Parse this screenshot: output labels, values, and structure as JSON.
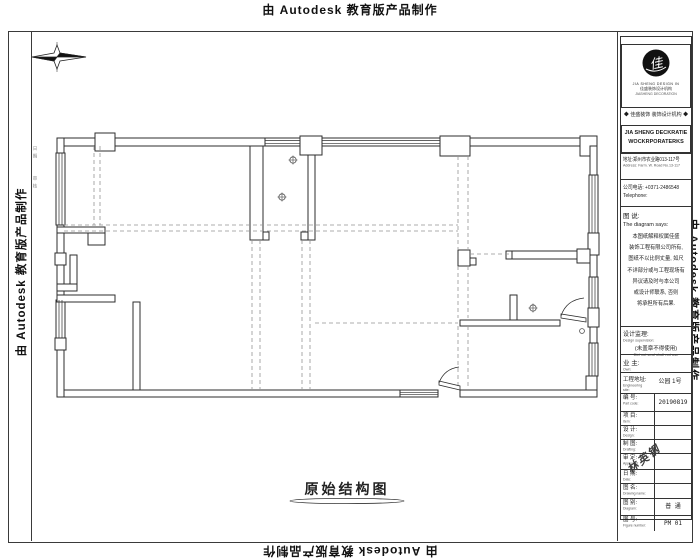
{
  "watermark": {
    "text": "由 Autodesk 教育版产品制作"
  },
  "margin_notes": {
    "note1": "日 期",
    "note2": "审 核"
  },
  "plan": {
    "title": "原始结构图",
    "icons": {
      "compass": "north-arrow-compass",
      "column_marker": "circled-cross-marker"
    }
  },
  "title_block": {
    "logo": {
      "mark_text": "佳盛",
      "caption_en": "JIA SHENG DESIGN IN",
      "caption_zh": "佳盛装饰设计机构",
      "caption_sub": "JIASHENG DECORATION"
    },
    "tagline": "◆ 佳盛装饰 装饰设计机构 ◆",
    "company_en_line1": "JIA SHENG DECKRATIE",
    "company_en_line2": "WOCKRPORATERKS",
    "address_zh": "地址:郑州市农业路013-117号",
    "address_en": "Address: Farm. W. Road No.13-117",
    "phone_zh": "公司电话: +0371-2486548",
    "phone_en": "Telephone:",
    "note_title_zh": "图 说:",
    "note_title_en": "The diagram says:",
    "note_lines": [
      "本图纸解释权属佳盛",
      "装饰工程有限公司所有,",
      "图纸不以比例丈量, 如尺",
      "不详部分或与工程现场有",
      "异议请及时与本公司",
      "或设计师联系, 否则",
      "将承担所有后果."
    ],
    "supervisor_label": "设计监理:",
    "supervisor_en": "Design supervision:",
    "seal_note_zh": "(未盖章不得使用)",
    "seal_note_en": "Did not seal shall not use",
    "owner_label": "业 主:",
    "owner_en": "Own:",
    "site_label": "工程地址:",
    "site_en": "Engineering site:",
    "site_value": "公园 1号",
    "rows": [
      {
        "label": "编 号:",
        "en": "Part code:",
        "value": "20190819"
      },
      {
        "label": "项 目:",
        "en": "Item:",
        "value": ""
      },
      {
        "label": "设 计:",
        "en": "Design:",
        "value": ""
      },
      {
        "label": "制 图:",
        "en": "Drafting:",
        "value": ""
      },
      {
        "label": "审 定:",
        "en": "Approved:",
        "value": ""
      },
      {
        "label": "日 期:",
        "en": "Date:",
        "value": ""
      },
      {
        "label": "图 名:",
        "en": "Drawing name:",
        "value": ""
      },
      {
        "label": "图 别:",
        "en": "Diagram:",
        "value": "普 通"
      },
      {
        "label": "图 号:",
        "en": "Figure number:",
        "value": "PM 01"
      }
    ],
    "signature": "林英钢"
  }
}
